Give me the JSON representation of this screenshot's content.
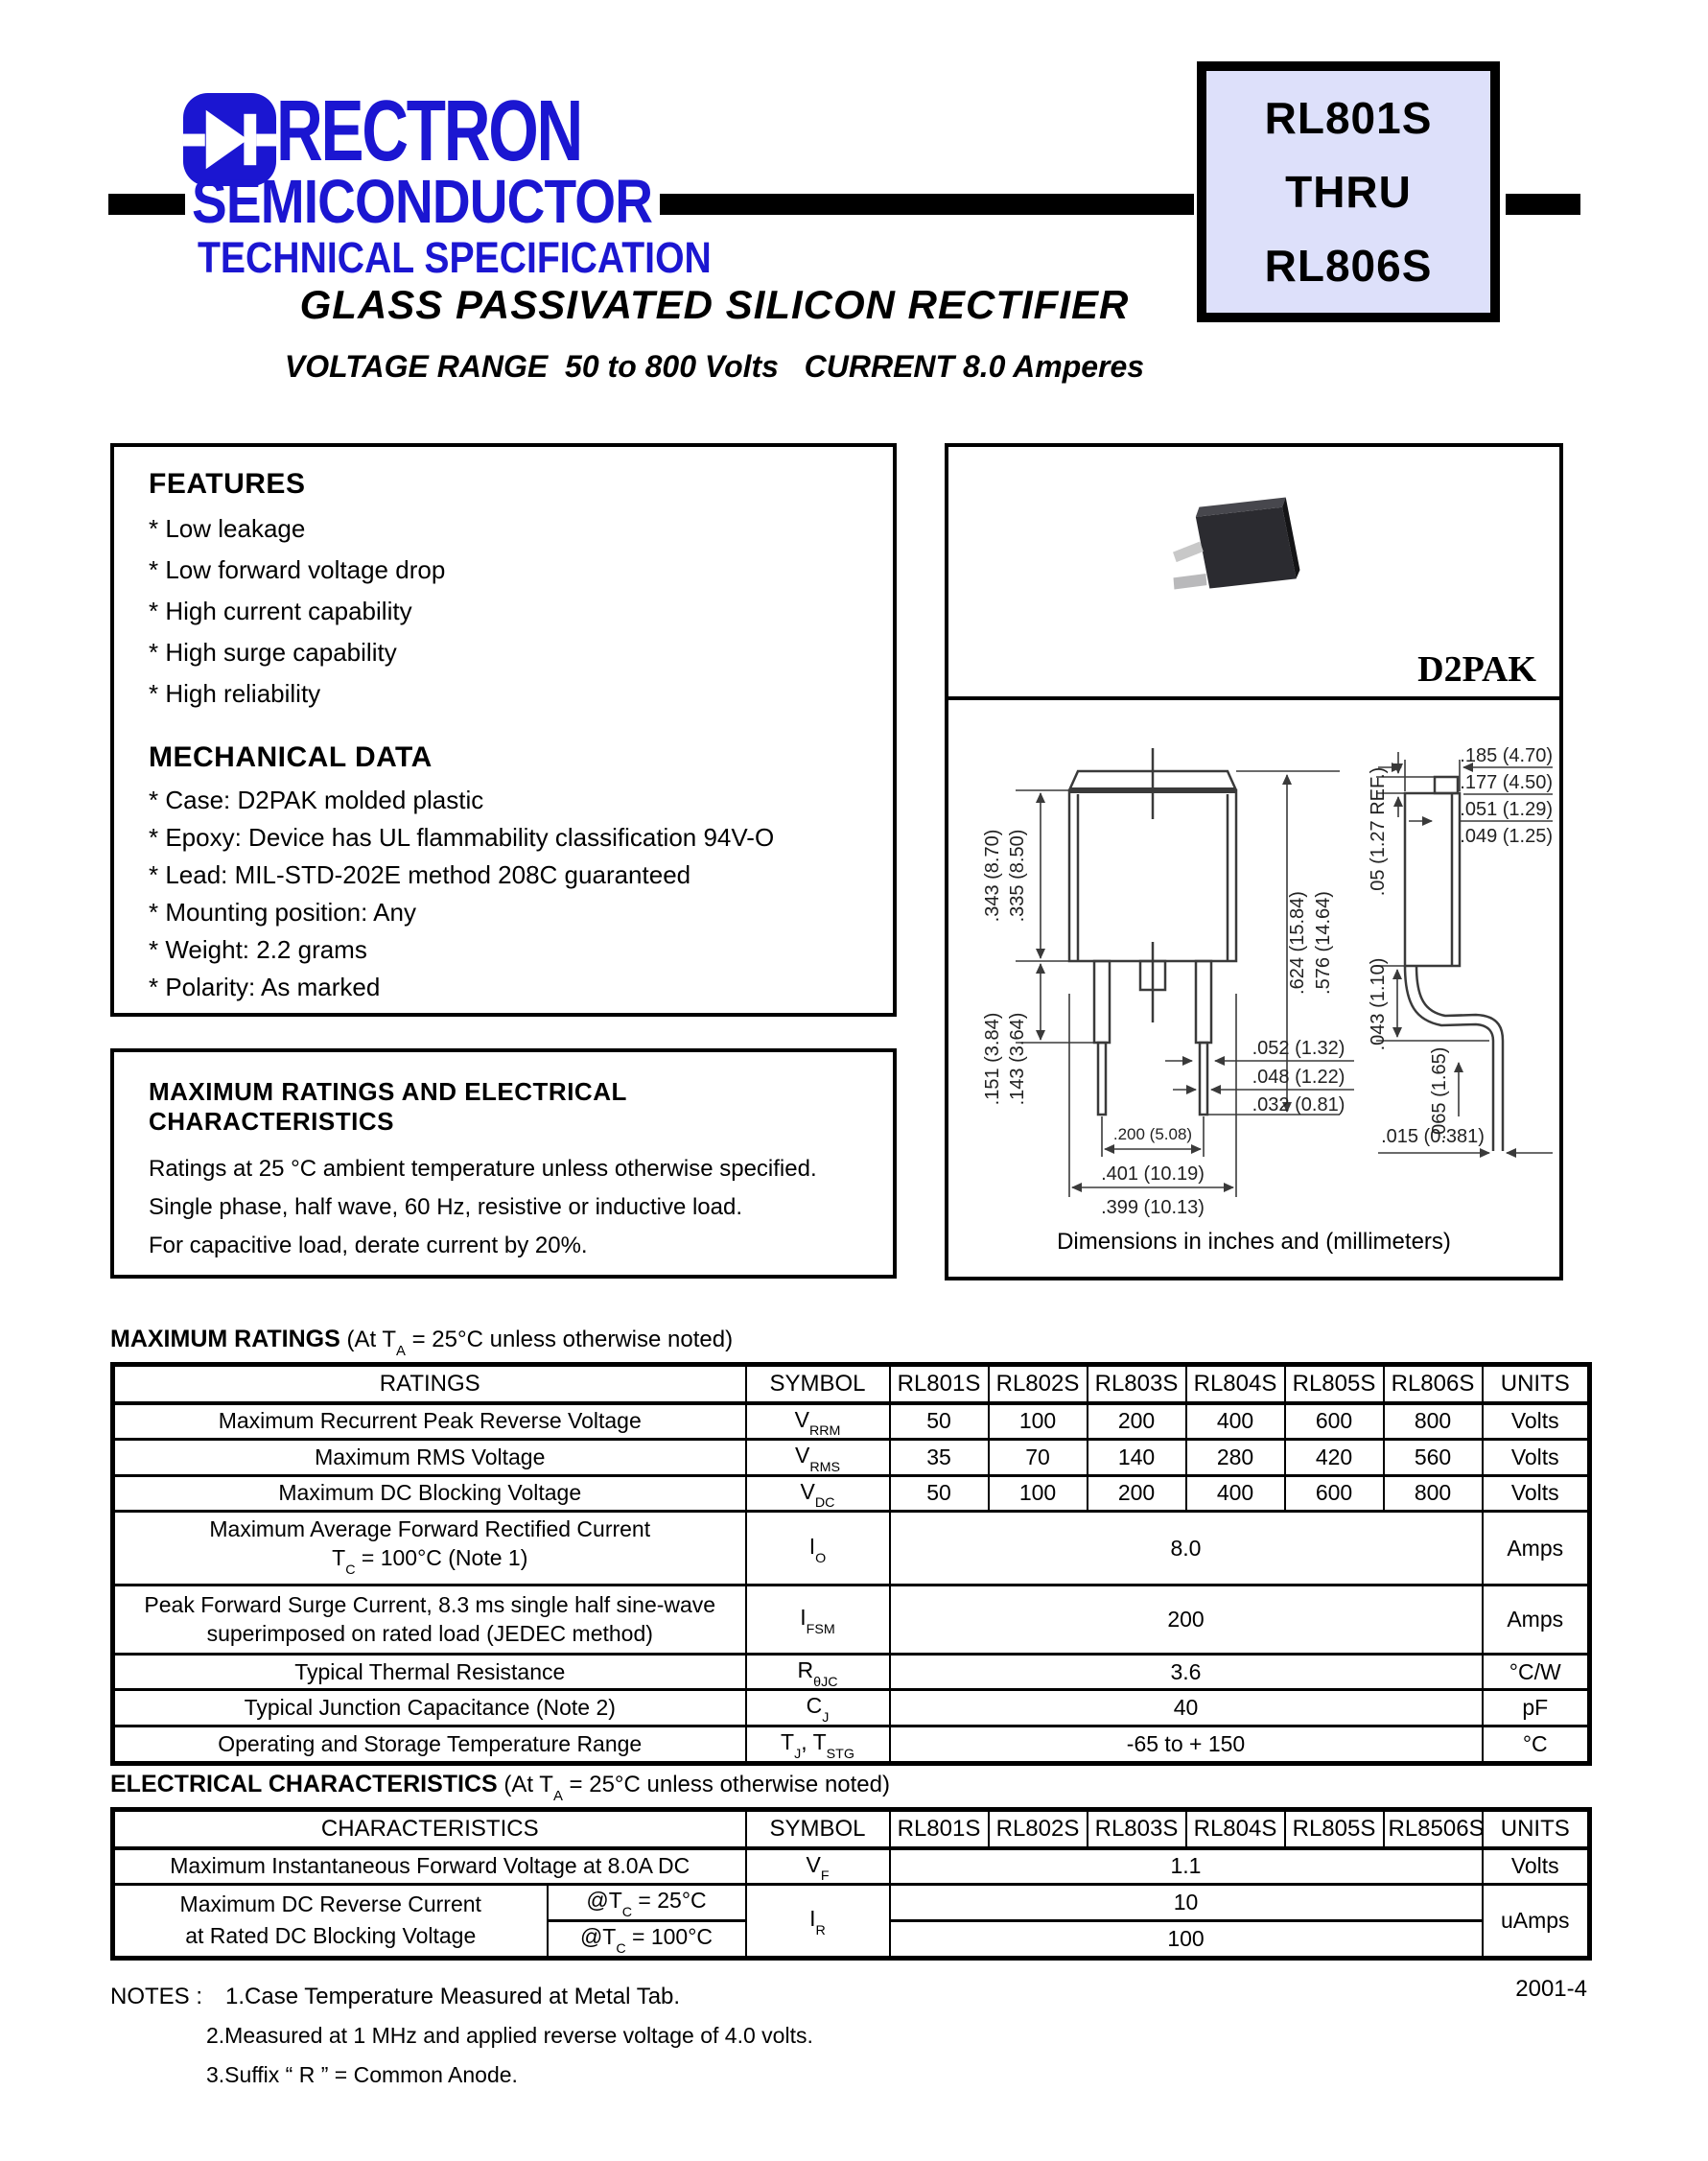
{
  "colors": {
    "brand_blue": "#1b16d1",
    "part_box_bg": "#dde0fa",
    "bar_black": "#000000"
  },
  "header": {
    "brand": "RECTRON",
    "brand_line2": "SEMICONDUCTOR",
    "brand_line3": "TECHNICAL SPECIFICATION",
    "part_box": [
      "RL801S",
      "THRU",
      "RL806S"
    ],
    "title": "GLASS PASSIVATED SILICON RECTIFIER",
    "subtitle": "VOLTAGE RANGE  50 to 800 Volts   CURRENT 8.0 Amperes"
  },
  "features": {
    "heading": "FEATURES",
    "items": [
      "* Low leakage",
      "* Low forward voltage drop",
      "* High current capability",
      "* High surge capability",
      "* High reliability"
    ]
  },
  "mechanical": {
    "heading": "MECHANICAL DATA",
    "items": [
      "* Case: D2PAK molded plastic",
      "* Epoxy: Device has UL flammability classification 94V-O",
      "* Lead: MIL-STD-202E method 208C guaranteed",
      "* Mounting position: Any",
      "* Weight: 2.2 grams",
      "* Polarity: As marked"
    ]
  },
  "ratings_box": {
    "heading": "MAXIMUM RATINGS AND ELECTRICAL CHARACTERISTICS",
    "lines": [
      "Ratings at 25 °C ambient temperature unless otherwise specified.",
      "Single phase, half wave, 60 Hz, resistive or inductive load.",
      "For capacitive load, derate current by 20%."
    ]
  },
  "package": {
    "name": "D2PAK",
    "caption": "Dimensions in inches and (millimeters)",
    "front": {
      "height_max": ".343 (8.70)",
      "height_min": ".335 (8.50)",
      "lead_len_max": ".151 (3.84)",
      "lead_len_min": ".143 (3.64)",
      "overall_max": ".624 (15.84)",
      "overall_min": ".576 (14.64)",
      "lead_w_max": ".052 (1.32)",
      "lead_w_min": ".048 (1.22)",
      "lead_w_thin": ".032 (0.81)",
      "pitch": ".200 (5.08)",
      "width_max": ".401 (10.19)",
      "width_min": ".399 (10.13)"
    },
    "side": {
      "tab_ref": ".05 (1.27 REF.)",
      "thick_max": ".185 (4.70)",
      "thick_min": ".177 (4.50)",
      "tab_t_max": ".051 (1.29)",
      "tab_t_min": ".049 (1.25)",
      "drop": ".043 (1.10)",
      "lead_t": ".065 (1.65)",
      "foot_t": ".015 (0.381)"
    }
  },
  "max_ratings": {
    "label_bold": "MAXIMUM RATINGS",
    "label_pre": "(At T",
    "label_sub": "A",
    "label_post": " = 25°C unless otherwise noted)",
    "headers": [
      "RATINGS",
      "SYMBOL",
      "RL801S",
      "RL802S",
      "RL803S",
      "RL804S",
      "RL805S",
      "RL806S",
      "UNITS"
    ],
    "rows": {
      "r1": {
        "name": "Maximum Recurrent Peak Reverse Voltage",
        "sym_base": "V",
        "sym_sub": "RRM",
        "v1": "50",
        "v2": "100",
        "v3": "200",
        "v4": "400",
        "v5": "600",
        "v6": "800",
        "unit": "Volts"
      },
      "r2": {
        "name": "Maximum RMS Voltage",
        "sym_base": "V",
        "sym_sub": "RMS",
        "v1": "35",
        "v2": "70",
        "v3": "140",
        "v4": "280",
        "v5": "420",
        "v6": "560",
        "unit": "Volts"
      },
      "r3": {
        "name": "Maximum DC Blocking Voltage",
        "sym_base": "V",
        "sym_sub": "DC",
        "v1": "50",
        "v2": "100",
        "v3": "200",
        "v4": "400",
        "v5": "600",
        "v6": "800",
        "unit": "Volts"
      },
      "r4": {
        "line1": "Maximum Average Forward Rectified Current",
        "line2_pre": "T",
        "line2_sub": "C",
        "line2_post": " = 100°C (Note 1)",
        "sym_base": "I",
        "sym_sub": "O",
        "value": "8.0",
        "unit": "Amps"
      },
      "r5": {
        "line1": "Peak Forward Surge Current, 8.3 ms single half sine-wave",
        "line2": "superimposed on rated load (JEDEC method)",
        "sym_base": "I",
        "sym_sub": "FSM",
        "value": "200",
        "unit": "Amps"
      },
      "r6": {
        "name": "Typical Thermal Resistance",
        "sym_base": "R",
        "sym_sub": "θJC",
        "value": "3.6",
        "unit": "°C/W"
      },
      "r7": {
        "name": "Typical Junction Capacitance (Note 2)",
        "sym_base": "C",
        "sym_sub": "J",
        "value": "40",
        "unit": "pF"
      },
      "r8": {
        "name": "Operating and Storage Temperature Range",
        "sym_base": "T",
        "sym_sub": "J",
        "sym_base2": ", T",
        "sym_sub2": "STG",
        "value": "-65 to + 150",
        "unit": "°C"
      }
    }
  },
  "electrical": {
    "label_bold": "ELECTRICAL CHARACTERISTICS",
    "label_pre": "(At T",
    "label_sub": "A",
    "label_post": " = 25°C unless otherwise noted)",
    "headers": [
      "CHARACTERISTICS",
      "SYMBOL",
      "RL801S",
      "RL802S",
      "RL803S",
      "RL804S",
      "RL805S",
      "RL8506S",
      "UNITS"
    ],
    "vf": {
      "name": "Maximum Instantaneous Forward Voltage at 8.0A DC",
      "sym_base": "V",
      "sym_sub": "F",
      "value": "1.1",
      "unit": "Volts"
    },
    "ir": {
      "line1": "Maximum DC Reverse Current",
      "line2": "at Rated DC Blocking Voltage",
      "cond1_pre": "@T",
      "cond1_sub": "C",
      "cond1_post": " = 25°C",
      "cond2_pre": "@T",
      "cond2_sub": "C",
      "cond2_post": " = 100°C",
      "sym_base": "I",
      "sym_sub": "R",
      "v1": "10",
      "v2": "100",
      "unit": "uAmps"
    }
  },
  "notes": {
    "label": "NOTES :",
    "n1": "1.Case Temperature Measured at Metal Tab.",
    "n2": "2.Measured at 1 MHz and applied reverse voltage of 4.0 volts.",
    "n3": "3.Suffix “ R ” = Common  Anode."
  },
  "page": {
    "doc_number": "2001-4"
  }
}
